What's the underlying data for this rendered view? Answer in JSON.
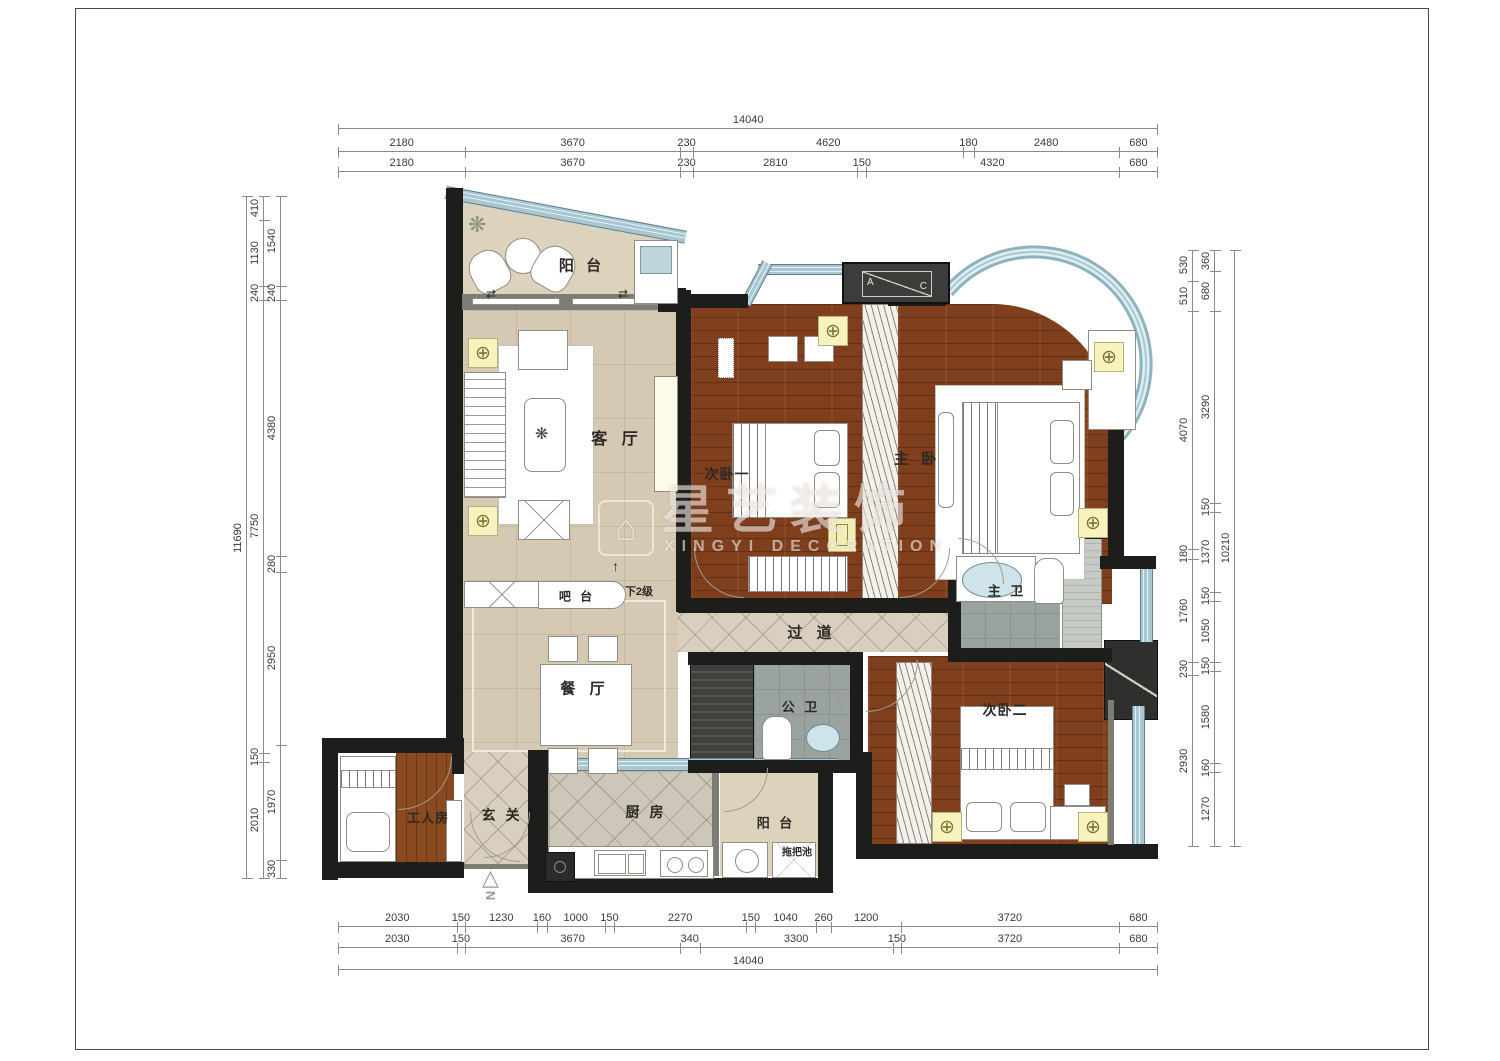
{
  "watermark": {
    "logo_glyph": "⌂",
    "title_cn": "星艺装饰",
    "title_en": "XINGYI  DECORATION"
  },
  "glyphs": {
    "lamp": "⊕",
    "plant": "❋",
    "north_letter": "N",
    "north_triangle": "△",
    "up_arrow": "↑",
    "slide_arrows": "⇄"
  },
  "ac_unit": {
    "left": "A",
    "right": "C"
  },
  "rooms": [
    {
      "id": "balcony-top",
      "label": "阳 台",
      "x": 582,
      "y": 265,
      "fs": 15,
      "ls": 4
    },
    {
      "id": "living-room",
      "label": "客 厅",
      "x": 617,
      "y": 437,
      "fs": 16,
      "ls": 5
    },
    {
      "id": "bedroom-1",
      "label": "次卧一",
      "x": 727,
      "y": 474,
      "fs": 14,
      "ls": 1
    },
    {
      "id": "master-bedroom",
      "label": "主 卧",
      "x": 917,
      "y": 458,
      "fs": 15,
      "ls": 4
    },
    {
      "id": "corridor",
      "label": "过 道",
      "x": 812,
      "y": 632,
      "fs": 15,
      "ls": 5
    },
    {
      "id": "master-bath",
      "label": "主 卫",
      "x": 1007,
      "y": 590,
      "fs": 13,
      "ls": 3
    },
    {
      "id": "dining-room",
      "label": "餐 厅",
      "x": 585,
      "y": 688,
      "fs": 15,
      "ls": 5
    },
    {
      "id": "public-bath",
      "label": "公 卫",
      "x": 801,
      "y": 706,
      "fs": 13,
      "ls": 3
    },
    {
      "id": "bedroom-2",
      "label": "次卧二",
      "x": 1005,
      "y": 710,
      "fs": 14,
      "ls": 1
    },
    {
      "id": "maid-room",
      "label": "工人房",
      "x": 428,
      "y": 817,
      "fs": 13,
      "ls": 1
    },
    {
      "id": "entry",
      "label": "玄 关",
      "x": 502,
      "y": 815,
      "fs": 14,
      "ls": 3
    },
    {
      "id": "kitchen",
      "label": "厨 房",
      "x": 646,
      "y": 812,
      "fs": 14,
      "ls": 3
    },
    {
      "id": "balcony-bottom",
      "label": "阳 台",
      "x": 776,
      "y": 822,
      "fs": 13,
      "ls": 3
    },
    {
      "id": "mop-sink",
      "label": "拖把池",
      "x": 797,
      "y": 851,
      "fs": 10,
      "ls": 0
    },
    {
      "id": "bar-counter",
      "label": "吧 台",
      "x": 577,
      "y": 596,
      "fs": 12,
      "ls": 3
    },
    {
      "id": "steps-down",
      "label": "下2级",
      "x": 639,
      "y": 591,
      "fs": 11,
      "ls": 0
    }
  ],
  "dimensions": {
    "px_per_mm": 0.05843,
    "chains": [
      {
        "name": "top-total",
        "dir": "h",
        "x": 338,
        "y": 128,
        "segments": [
          "14040"
        ]
      },
      {
        "name": "top-row-1",
        "dir": "h",
        "x": 338,
        "y": 151,
        "segments": [
          "2180",
          "3670",
          "230",
          "4620",
          "180",
          "2480",
          "680"
        ]
      },
      {
        "name": "top-row-2",
        "dir": "h",
        "x": 338,
        "y": 171,
        "segments": [
          "2180",
          "3670",
          "230",
          "2810",
          "150",
          "4320",
          "680"
        ]
      },
      {
        "name": "bottom-row-1",
        "dir": "h",
        "x": 338,
        "y": 926,
        "segments": [
          "2030",
          "150",
          "1230",
          "160",
          "1000",
          "150",
          "2270",
          "150",
          "1040",
          "260",
          "1200",
          "3720",
          "680"
        ]
      },
      {
        "name": "bottom-row-2",
        "dir": "h",
        "x": 338,
        "y": 947,
        "segments": [
          "2030",
          "150",
          "3670",
          "340",
          "3300",
          "150",
          "3720",
          "680"
        ]
      },
      {
        "name": "bottom-total",
        "dir": "h",
        "x": 338,
        "y": 969,
        "segments": [
          "14040"
        ]
      },
      {
        "name": "left-total",
        "dir": "v",
        "x": 246,
        "y": 196,
        "segments": [
          "11690"
        ]
      },
      {
        "name": "left-middle",
        "dir": "v",
        "x": 263,
        "y": 196,
        "segments": [
          "410",
          "1130",
          "240",
          "7750",
          "150",
          "2010"
        ]
      },
      {
        "name": "left-inner",
        "dir": "v",
        "x": 280,
        "y": 196,
        "segments": [
          "1540",
          "240",
          "4380",
          "280",
          "2950",
          "1970",
          "330"
        ]
      },
      {
        "name": "right-inner",
        "dir": "v",
        "x": 1192,
        "y": 250,
        "segments": [
          "530",
          "510",
          "4070",
          "180",
          "1760",
          "230",
          "2930"
        ]
      },
      {
        "name": "right-middle",
        "dir": "v",
        "x": 1214,
        "y": 250,
        "segments": [
          "360",
          "680",
          "3290",
          "150",
          "1370",
          "150",
          "1050",
          "150",
          "1580",
          "160",
          "1270"
        ]
      },
      {
        "name": "right-total",
        "dir": "v",
        "x": 1234,
        "y": 250,
        "segments": [
          "10210"
        ]
      }
    ]
  },
  "colors": {
    "wall": "#1d1d1b",
    "glass": "#a9c7d3",
    "wood_floor": "#7f3f1c",
    "beige_floor": "#d6c9b4",
    "gray_tile": "#9ba3a1",
    "lamp_yellow": "#f7f3bf"
  }
}
